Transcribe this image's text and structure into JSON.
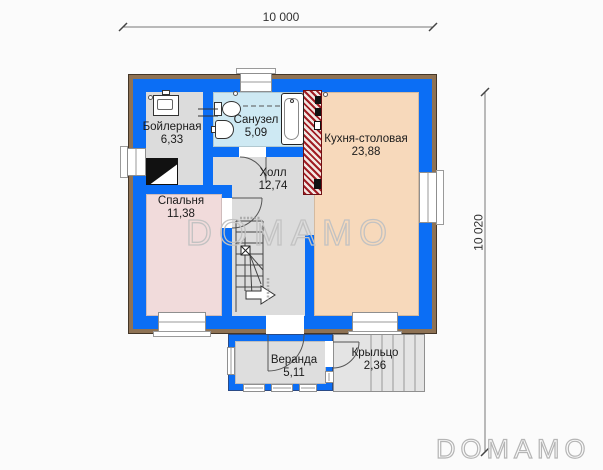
{
  "plan": {
    "dimensions": {
      "width_label": "10 000",
      "height_label": "10 020"
    },
    "rooms": [
      {
        "id": "boiler",
        "name": "Бойлерная",
        "area": "6,33"
      },
      {
        "id": "bathroom",
        "name": "Санузел",
        "area": "5,09"
      },
      {
        "id": "kitchen",
        "name": "Кухня-столовая",
        "area": "23,88"
      },
      {
        "id": "hall",
        "name": "Холл",
        "area": "12,74"
      },
      {
        "id": "bedroom",
        "name": "Спальня",
        "area": "11,38"
      },
      {
        "id": "veranda",
        "name": "Веранда",
        "area": "5,11"
      },
      {
        "id": "porch",
        "name": "Крыльцо",
        "area": "2,36"
      }
    ],
    "watermark": "DOMAMO",
    "logo": "DOMAMO",
    "colors": {
      "wall_blue": "#0b6ef5",
      "trim_brown": "#8e7254",
      "bathroom_floor": "#cee9f3",
      "kitchen_floor": "#f7d9bb",
      "bedroom_floor": "#f1dbdb",
      "hall_floor": "#dcdcdc",
      "veranda_floor": "#dedede",
      "porch_floor": "#e4e4e4",
      "chimney_red": "#a01d24"
    },
    "icons": {
      "boiler": "rect-appliance",
      "toilet": "tank-and-bowl",
      "sink": "half-round-basin",
      "bathtub": "rounded-tub",
      "stairs": "steps-with-turn-arrow",
      "chimney": "brick-hatch-block"
    }
  }
}
